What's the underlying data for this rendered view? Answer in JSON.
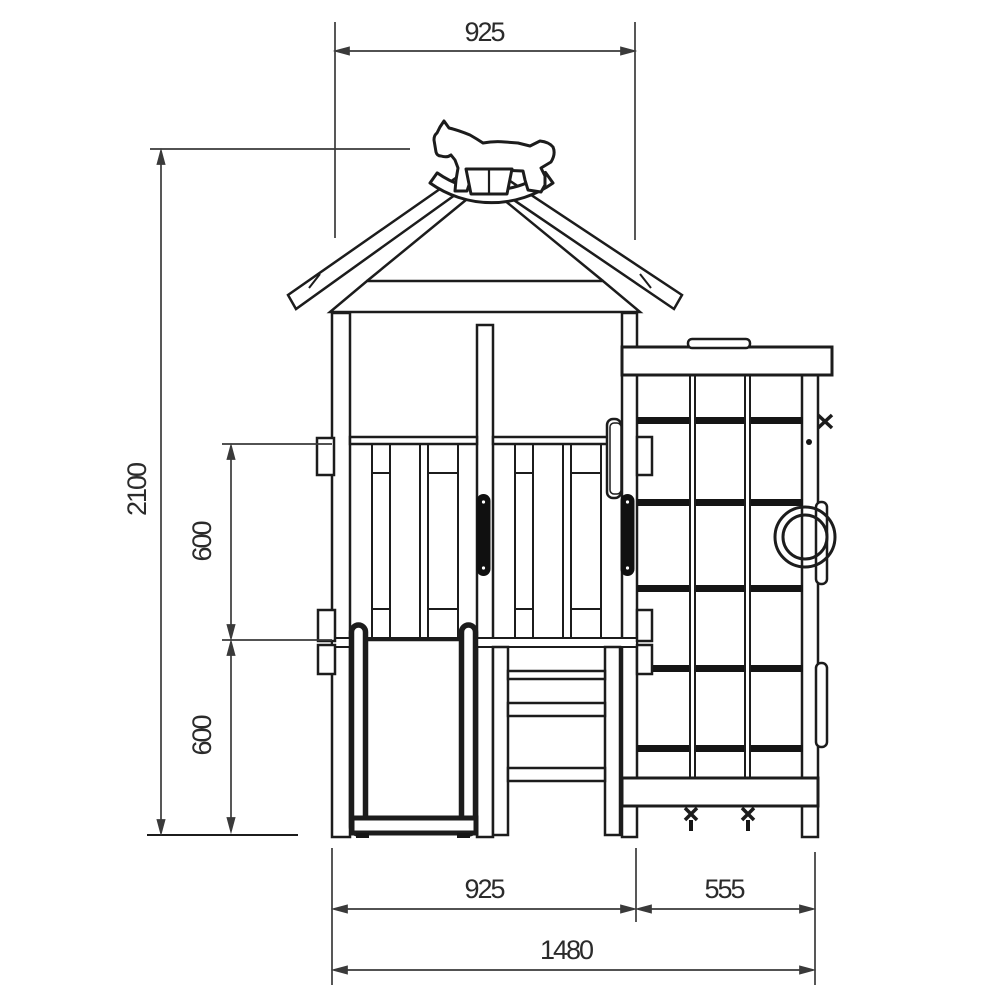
{
  "drawing": {
    "description": "Front elevation technical drawing of a children's playhouse tower with slide, access ladder, climbing-wall side module and rocking-horse roof finial",
    "colors": {
      "background": "#ffffff",
      "line": "#1c1c1c",
      "dimension_line": "#333333",
      "text": "#2b2b2b"
    },
    "dimensions": {
      "roof_width": "925",
      "overall_height": "2100",
      "upper_rail_spacing": "600",
      "lower_rail_spacing": "600",
      "tower_width": "925",
      "side_module_width": "555",
      "overall_width": "1480"
    }
  }
}
